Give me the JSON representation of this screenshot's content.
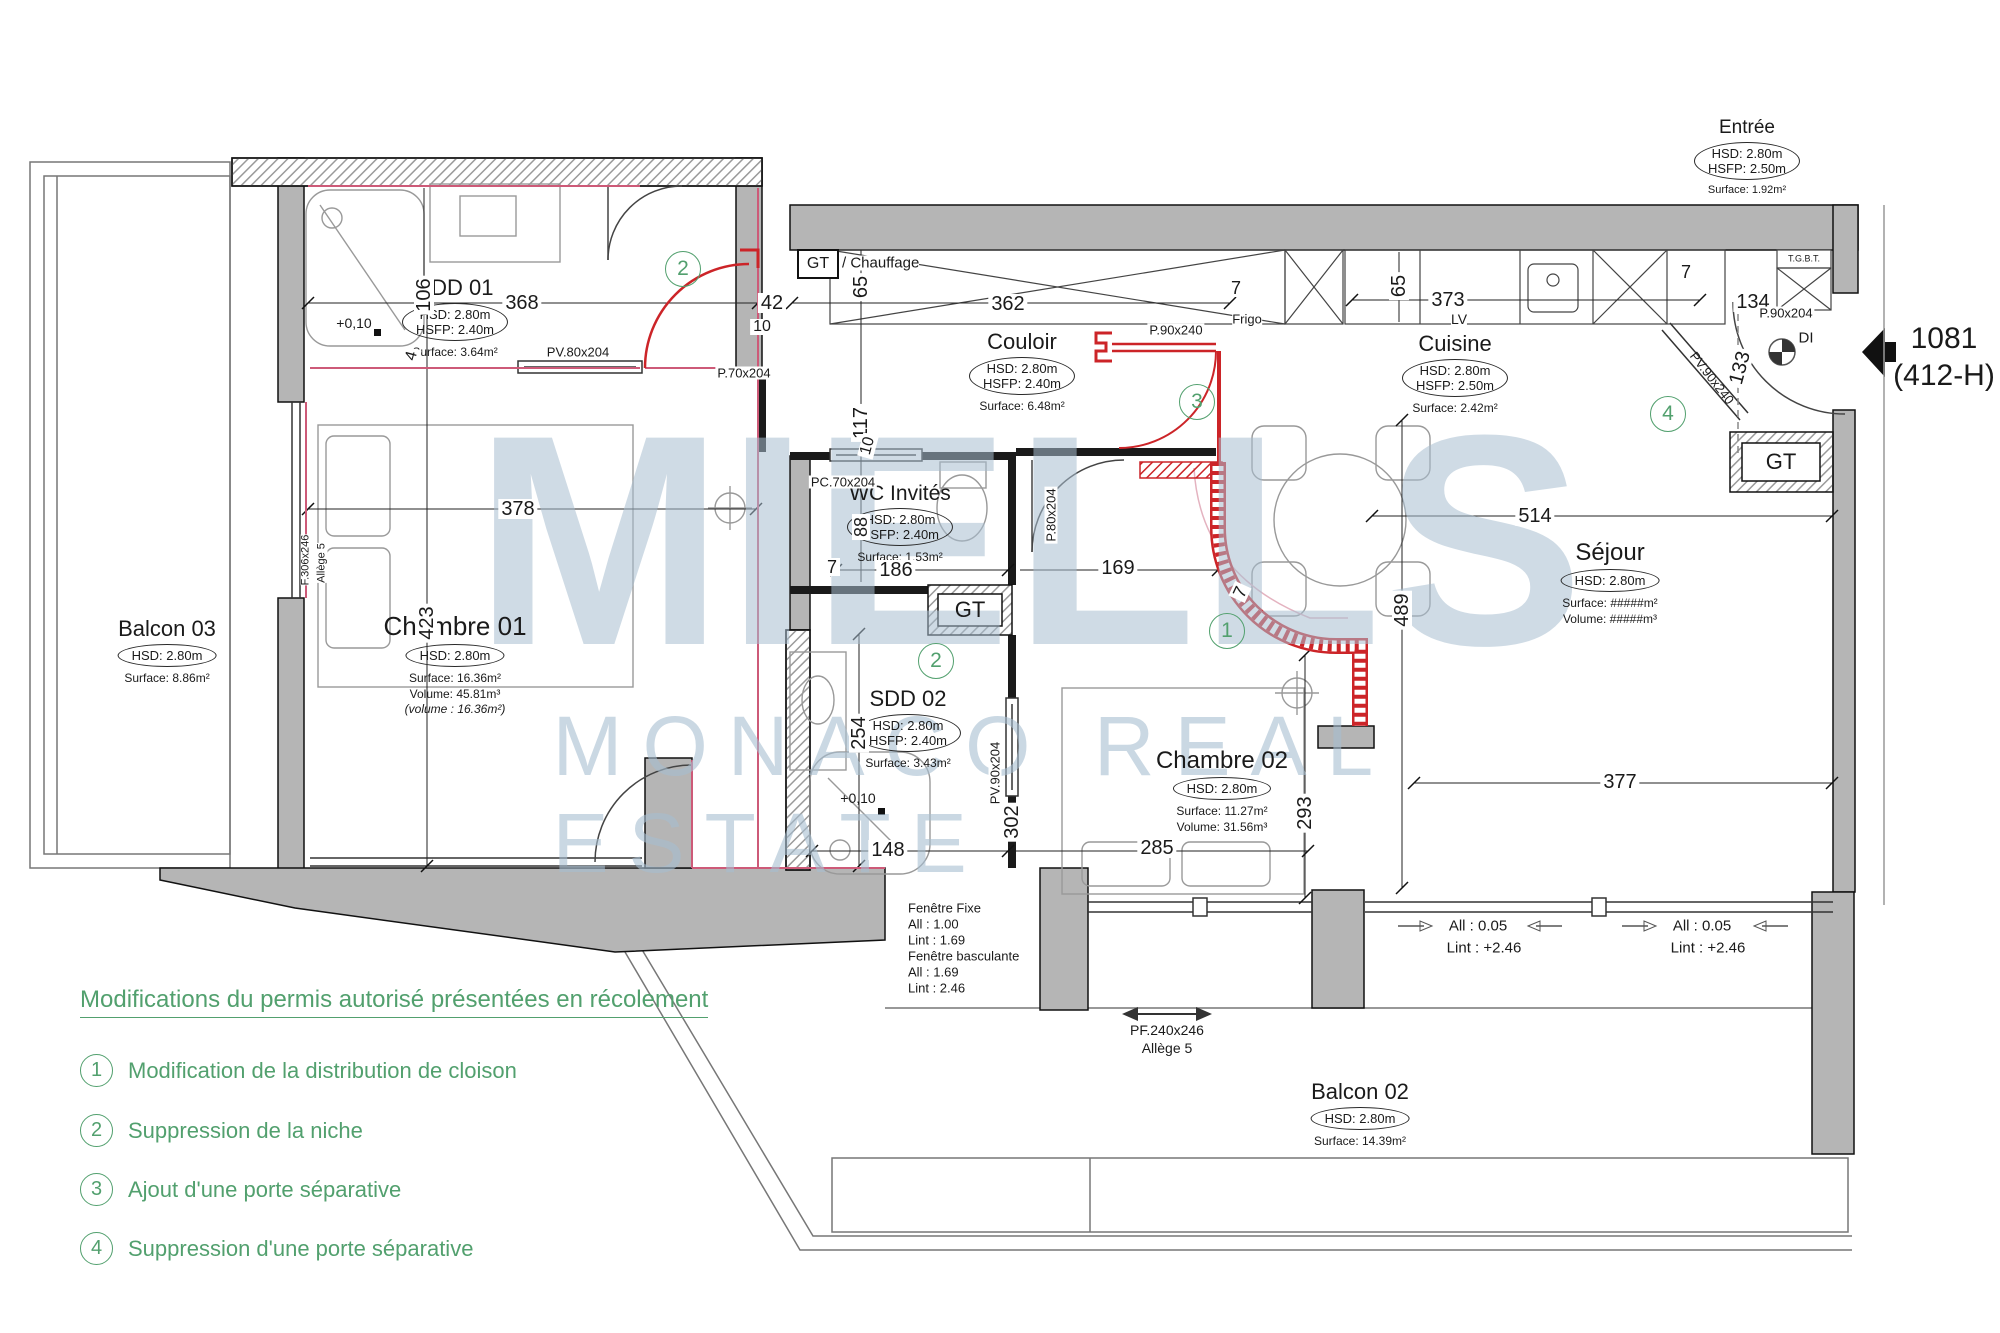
{
  "reference": {
    "number": "1081",
    "code": "(412-H)"
  },
  "watermark": {
    "line1": "MIELLS",
    "line2": "MONACO REAL ESTATE"
  },
  "legend": {
    "title": "Modifications du permis autorisé présentées en récolement",
    "items": [
      {
        "num": "1",
        "label": "Modification de la distribution de cloison"
      },
      {
        "num": "2",
        "label": "Suppression de la niche"
      },
      {
        "num": "3",
        "label": "Ajout d'une porte séparative"
      },
      {
        "num": "4",
        "label": "Suppression d'une porte séparative"
      }
    ]
  },
  "markers": [
    "1",
    "2",
    "3",
    "4"
  ],
  "rooms": {
    "entree": {
      "name": "Entrée",
      "hsd": "HSD: 2.80m",
      "hsfp": "HSFP: 2.50m",
      "surface": "Surface: 1.92m²"
    },
    "sdd01": {
      "name": "SDD 01",
      "hsd": "HSD: 2.80m",
      "hsfp": "HSFP: 2.40m",
      "surface": "Surface: 3.64m²"
    },
    "couloir": {
      "name": "Couloir",
      "hsd": "HSD: 2.80m",
      "hsfp": "HSFP: 2.40m",
      "surface": "Surface: 6.48m²"
    },
    "cuisine": {
      "name": "Cuisine",
      "hsd": "HSD: 2.80m",
      "hsfp": "HSFP: 2.50m",
      "surface": "Surface: 2.42m²"
    },
    "wc": {
      "name": "WC Invités",
      "hsd": "HSD: 2.80m",
      "hsfp": "HSFP: 2.40m",
      "surface": "Surface: 1.53m²"
    },
    "sdd02": {
      "name": "SDD 02",
      "hsd": "HSD: 2.80m",
      "hsfp": "HSFP: 2.40m",
      "surface": "Surface: 3.43m²"
    },
    "ch01": {
      "name": "Chambre 01",
      "hsd": "HSD: 2.80m",
      "surface": "Surface: 16.36m²",
      "volume": "Volume: 45.81m³",
      "note": "(volume : 16.36m²)"
    },
    "ch02": {
      "name": "Chambre 02",
      "hsd": "HSD: 2.80m",
      "surface": "Surface: 11.27m²",
      "volume": "Volume: 31.56m³"
    },
    "sejour": {
      "name": "Séjour",
      "hsd": "HSD: 2.80m",
      "surface": "Surface: #####m²",
      "volume": "Volume: #####m³"
    },
    "balcon03": {
      "name": "Balcon 03",
      "hsd": "HSD: 2.80m",
      "surface": "Surface: 8.86m²"
    },
    "balcon02": {
      "name": "Balcon 02",
      "hsd": "HSD: 2.80m",
      "surface": "Surface: 14.39m²"
    }
  },
  "dims": [
    "368",
    "42",
    "10",
    "106",
    "4",
    "378",
    "423",
    "65",
    "362",
    "7",
    "117",
    "10",
    "65",
    "373",
    "7",
    "134",
    "133",
    "88",
    "7",
    "186",
    "169",
    "254",
    "148",
    "302",
    "285",
    "293",
    "7",
    "489",
    "514",
    "377"
  ],
  "doors": [
    "PV.80x204",
    "P.70x204",
    "PC.70x204",
    "P.80x204",
    "P.90x240",
    "PV.90x204",
    "PV.90x240",
    "P.90x204",
    "F.306x246",
    "Allège 5"
  ],
  "labels": {
    "gt": "GT",
    "chauffage": "/ Chauffage",
    "frigo": "Frigo",
    "lv": "LV",
    "tgbt": "T.G.B.T.",
    "di": "DI",
    "level": "+0,10",
    "win": {
      "a": "Fenêtre Fixe",
      "b": "All : 1.00",
      "c": "Lint : 1.69",
      "d": "Fenêtre basculante",
      "e": "All : 1.69",
      "f": "Lint : 2.46"
    },
    "pf": "PF.240x246",
    "allege": "Allège 5",
    "all005": "All : 0.05",
    "lint": "Lint : +2.46"
  },
  "colors": {
    "legend_green": "#52a06e",
    "modification_red": "#cc2428",
    "trace_pink": "#cd5a78",
    "wall_grey": "#b5b5b5",
    "watermark_blue": "#a7becf"
  }
}
